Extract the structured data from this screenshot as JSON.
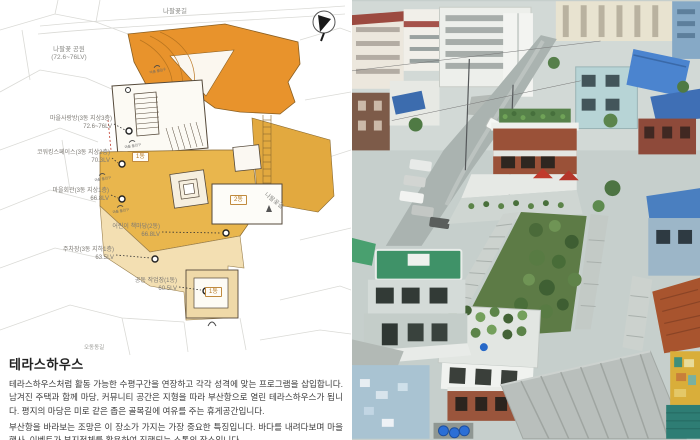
{
  "plan": {
    "roads": {
      "top": "나팔꽃길",
      "right": "나팔꽃길",
      "bottom": "오동동길"
    },
    "park": {
      "name": "나팔꽃 공원",
      "level": "(72.6~76LV)"
    },
    "annotations": [
      {
        "label": "마을사랑방(3동 지상3층)",
        "level": "72.6~76LV"
      },
      {
        "label": "코워킹스페이스(3동 지상2층)",
        "level": "70.3LV"
      },
      {
        "label": "마을회관(3동 지상1층)",
        "level": "66.8LV"
      },
      {
        "label": "주차장(3동 지하1층)",
        "level": "63.5LV"
      },
      {
        "label": "어린이 책마당(2동)",
        "level": "66.8LV"
      },
      {
        "label": "공동 작업장(1동)",
        "level": "60.5LV"
      }
    ],
    "badges": [
      "1동",
      "2동",
      "1동"
    ],
    "entrance_label": "마을 출입구"
  },
  "description": {
    "title": "테라스하우스",
    "paragraphs": [
      "테라스하우스처럼 활동 가능한 수평구간을 연장하고 각각 성격에 맞는 프로그램을 삽입합니다. 남겨진 주택과 함께 마당, 커뮤니티 공간은 지형을 따라 부산항으로 열린 테라스하우스가 됩니다. 평지의 마당은 미로 같은 좁은 골목길에 여유를 주는 휴게공간입니다.",
      "부산항을 바라보는 조망은 이 장소가 가지는 가장 중요한 특징입니다. 바다를 내려다보며 마을 행사, 이벤트가 부지전체를 활용하여 진행되는 소통의 장소입니다."
    ]
  },
  "colors": {
    "plaza_orange": "#E8932C",
    "terrace_amber": "#E9B64D",
    "terrace_cream": "#F3DFB2"
  }
}
